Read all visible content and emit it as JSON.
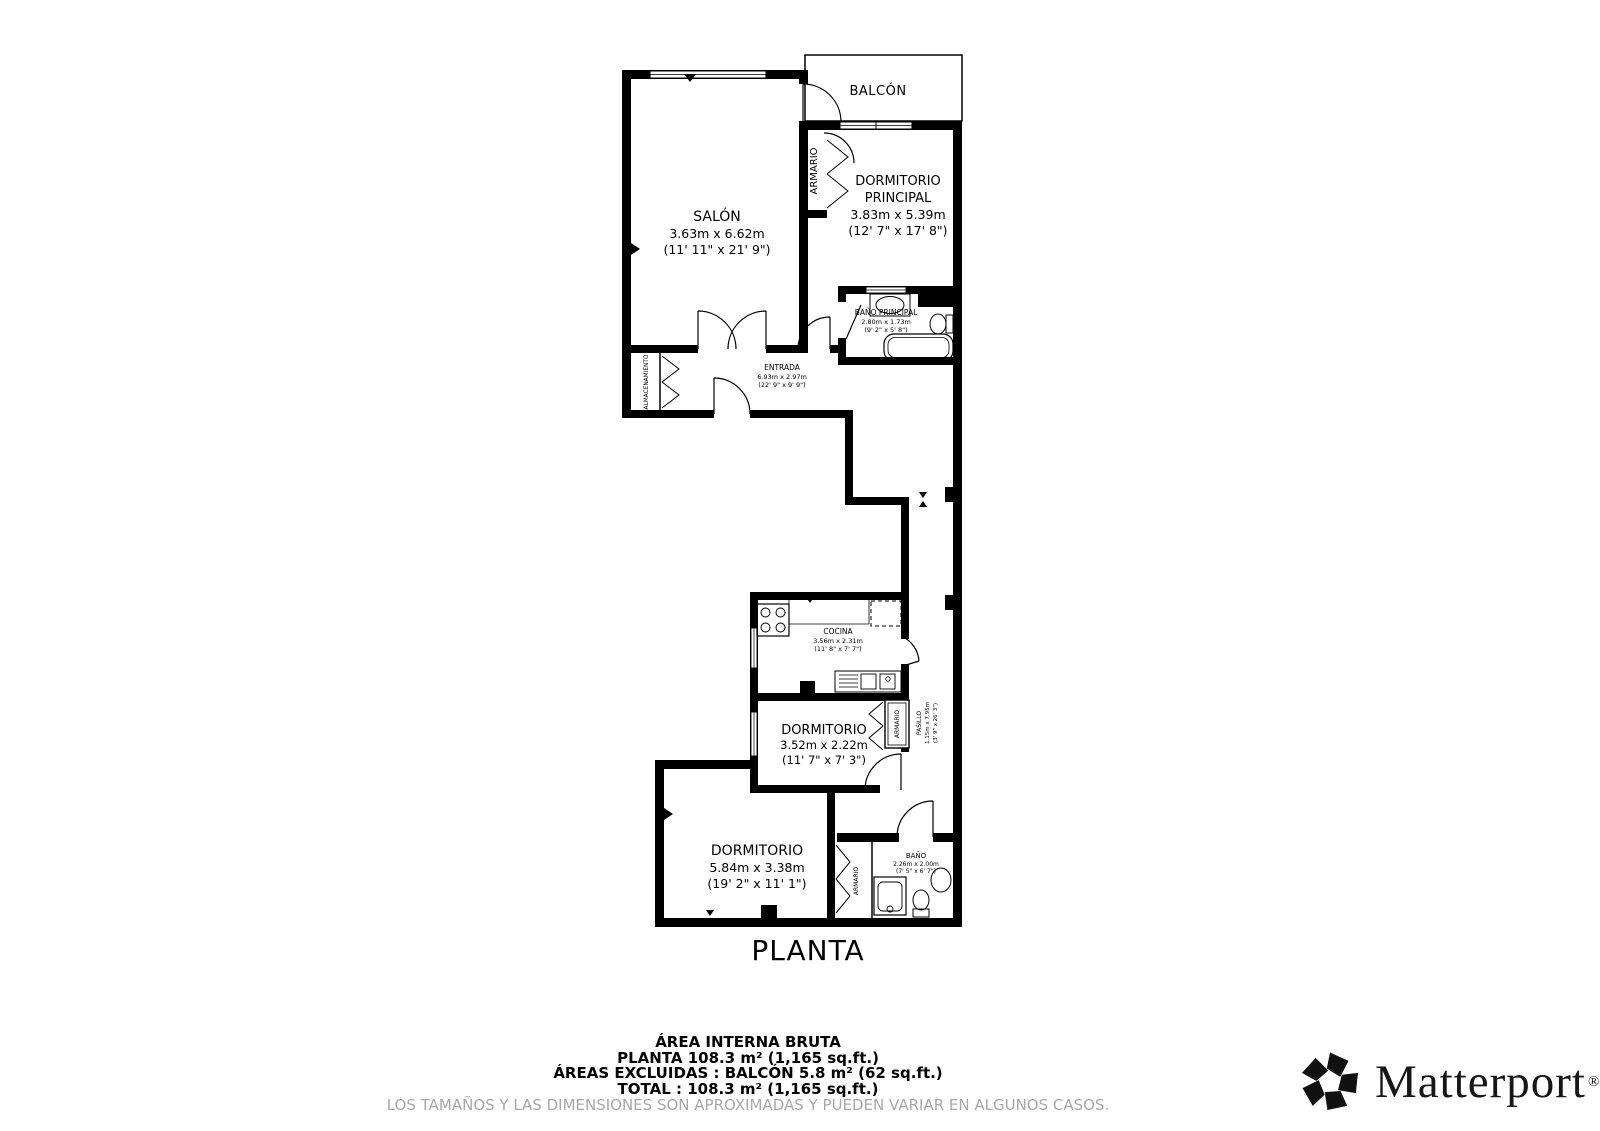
{
  "plan": {
    "title": "PLANTA",
    "rooms": {
      "balcon": {
        "name": "BALCÓN"
      },
      "salon": {
        "name": "SALÓN",
        "dims_m": "3.63m x 6.62m",
        "dims_ft": "(11' 11\" x 21' 9\")"
      },
      "armario_superior": {
        "name": "ARMARIO"
      },
      "dormitorio_principal": {
        "name_line1": "DORMITORIO",
        "name_line2": "PRINCIPAL",
        "dims_m": "3.83m x 5.39m",
        "dims_ft": "(12' 7\" x 17' 8\")"
      },
      "bano_principal": {
        "name": "BAÑO PRINCIPAL",
        "dims_m": "2.80m x 1.73m",
        "dims_ft": "(9' 2\" x 5' 8\")"
      },
      "entrada": {
        "name": "ENTRADA",
        "dims_m": "6.93m x 2.97m",
        "dims_ft": "(22' 9\" x 9' 9\")"
      },
      "almacenamiento": {
        "name": "ALMACENAMIENTO"
      },
      "cocina": {
        "name": "COCINA",
        "dims_m": "3.56m x 2.31m",
        "dims_ft": "(11' 8\" x 7' 7\")"
      },
      "dormitorio_medio": {
        "name": "DORMITORIO",
        "dims_m": "3.52m x 2.22m",
        "dims_ft": "(11' 7\" x 7' 3\")"
      },
      "armario_medio": {
        "name": "ARMARIO"
      },
      "pasillo": {
        "name": "PASILLO",
        "dims_m": "1.15m x 7.95m",
        "dims_ft": "(3' 9\" x 26' 3\")"
      },
      "dormitorio_inferior": {
        "name": "DORMITORIO",
        "dims_m": "5.84m x 3.38m",
        "dims_ft": "(19' 2\" x 11' 1\")"
      },
      "armario_inferior": {
        "name": "ARMARIO"
      },
      "bano": {
        "name": "BAÑO",
        "dims_m": "2.26m x 2.00m",
        "dims_ft": "(7' 5\" x 6' 7\")"
      }
    }
  },
  "summary": {
    "heading": "ÁREA INTERNA BRUTA",
    "planta": "PLANTA 108.3 m² (1,165 sq.ft.)",
    "excluidas": "ÁREAS EXCLUIDAS :  BALCÓN 5.8 m² (62 sq.ft.)",
    "total": "TOTAL :  108.3 m² (1,165 sq.ft.)",
    "disclaimer": "LOS TAMAÑOS Y LAS DIMENSIONES SON APROXIMADAS Y PUEDEN VARIAR EN ALGUNOS CASOS."
  },
  "branding": {
    "logo_text": "Matterport",
    "registered_mark": "®"
  },
  "colors": {
    "wall": "#000000",
    "text": "#000000",
    "disclaimer": "#a8a8a8",
    "background": "#ffffff"
  }
}
